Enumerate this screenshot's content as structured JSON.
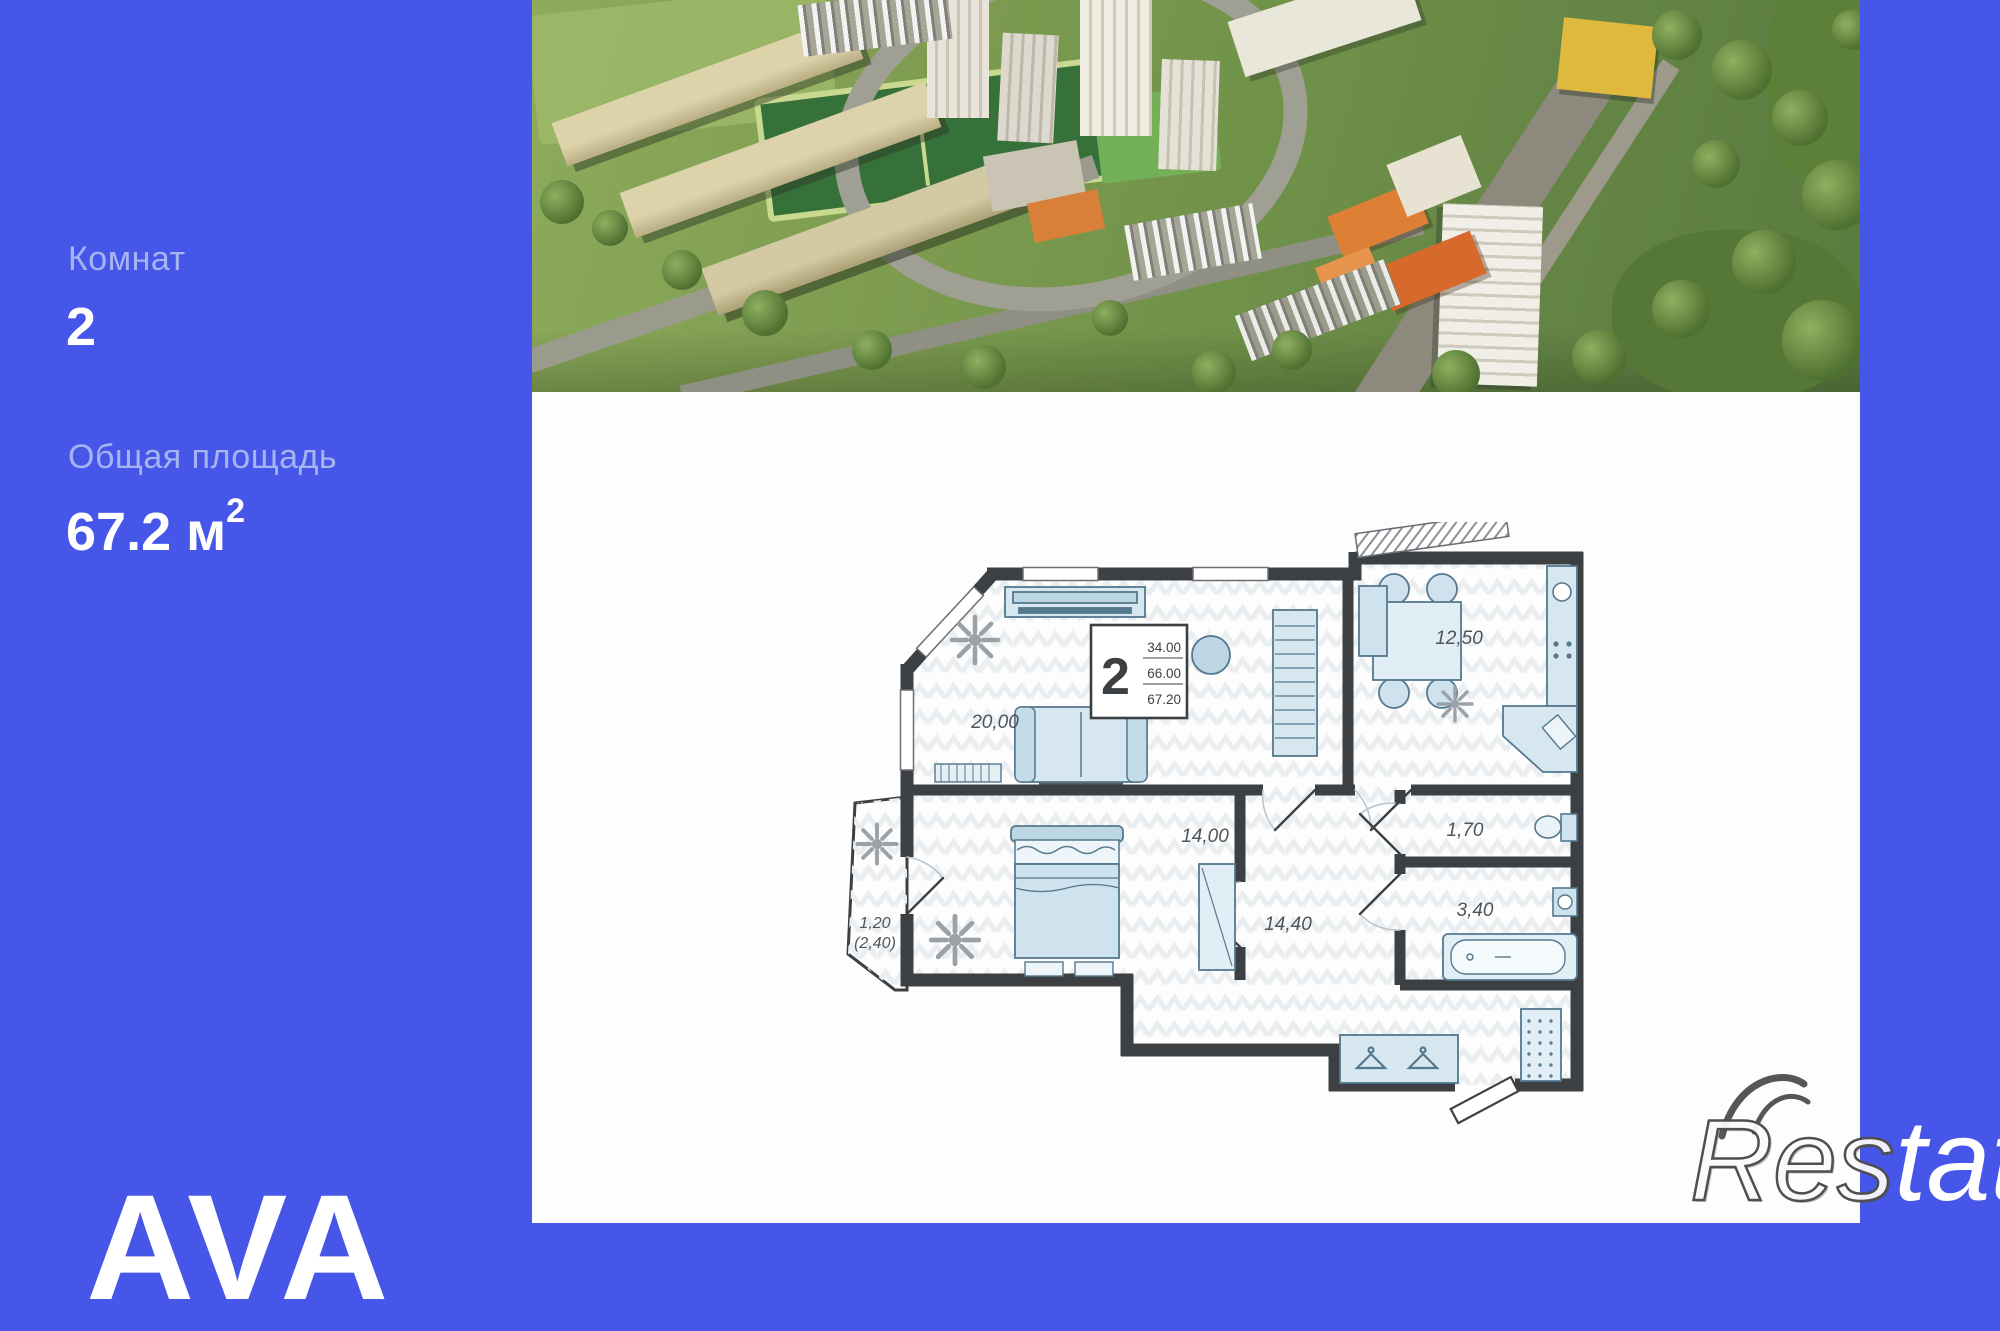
{
  "listing": {
    "rooms_label": "Комнат",
    "rooms_value": "2",
    "area_label": "Общая площадь",
    "area_value": "67.2",
    "area_unit": " м",
    "area_sup": "2",
    "brand": "AVA"
  },
  "floor_plan": {
    "stamp": {
      "rooms": "2",
      "values": [
        "34.00",
        "66.00",
        "67.20"
      ]
    },
    "labels": {
      "living": "20,00",
      "kitchen": "12,50",
      "bedroom": "14,00",
      "wc": "1,70",
      "hall": "14,40",
      "bath": "3,40",
      "balcony_line1": "1,20",
      "balcony_line2": "(2,40)"
    }
  },
  "watermark": {
    "left": "Res",
    "right": "tate"
  },
  "colors": {
    "background": "#4656e8",
    "label_text": "#a7b4f2",
    "value_text": "#ffffff",
    "plan_wall": "#3d4043",
    "furniture_fill": "#d7e7f0",
    "furniture_stroke": "#54788e",
    "plan_floor": "#fdfdfd"
  }
}
